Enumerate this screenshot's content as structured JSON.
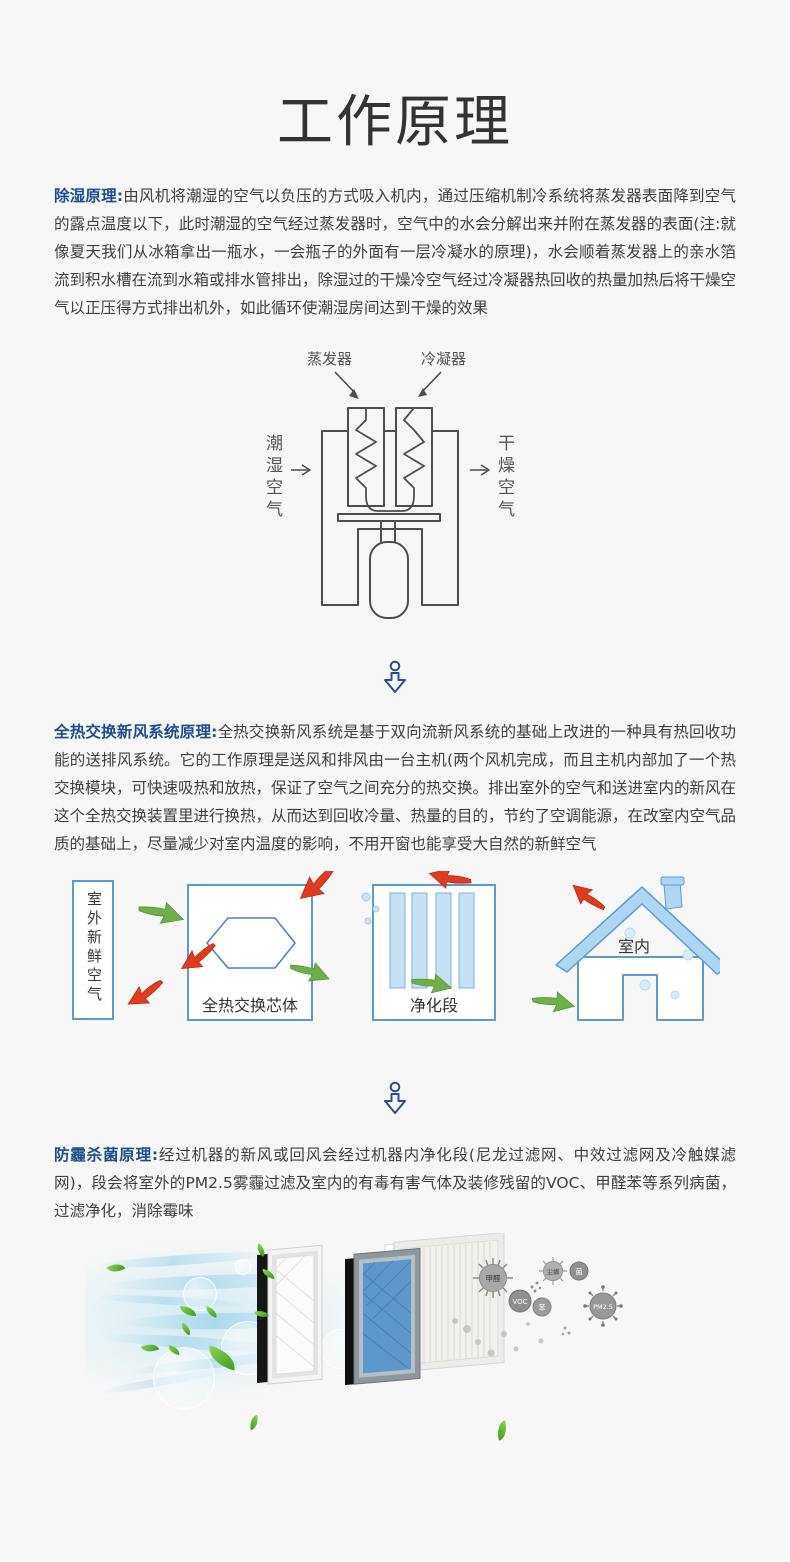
{
  "title": "工作原理",
  "sections": [
    {
      "label": "除湿原理:",
      "body": "由风机将潮湿的空气以负压的方式吸入机内，通过压缩机制冷系统将蒸发器表面降到空气的露点温度以下，此时潮湿的空气经过蒸发器时，空气中的水会分解出来并附在蒸发器的表面(注:就像夏天我们从冰箱拿出一瓶水，一会瓶子的外面有一层冷凝水的原理)，水会顺着蒸发器上的亲水箔流到积水槽在流到水箱或排水管排出，除湿过的干燥冷空气经过冷凝器热回收的热量加热后将干燥空气以正压得方式排出机外，如此循环使潮湿房间达到干燥的效果"
    },
    {
      "label": "全热交换新风系统原理:",
      "body": "全热交换新风系统是基于双向流新风系统的基础上改进的一种具有热回收功能的送排风系统。它的工作原理是送风和排风由一台主机(两个风机完成，而且主机内部加了一个热交换模块，可快速吸热和放热，保证了空气之间充分的热交换。排出室外的空气和送进室内的新风在这个全热交换装置里进行换热，从而达到回收冷量、热量的目的，节约了空调能源，在改室内空气品质的基础上，尽量减少对室内温度的影响，不用开窗也能享受大自然的新鲜空气"
    },
    {
      "label": "防霾杀菌原理:",
      "body": "经过机器的新风或回风会经过机器内净化段(尼龙过滤网、中效过滤网及冷触媒滤网)，段会将室外的PM2.5雾霾过滤及室内的有毒有害气体及装修残留的VOC、甲醛苯等系列病菌，过滤净化，消除霉味"
    }
  ],
  "diagram1": {
    "evaporator": "蒸发器",
    "condenser": "冷凝器",
    "humid_air": "潮湿空气",
    "dry_air": "干燥空气"
  },
  "diagram2": {
    "outdoor_air": "室外新鲜空气",
    "core": "全热交换芯体",
    "purify": "净化段",
    "indoor": "室内"
  },
  "filters": {
    "particles": [
      "甲醛",
      "VOC",
      "苯",
      "尘螨",
      "菌",
      "PM2.5"
    ]
  },
  "colors": {
    "accent_blue": "#1e4c8f",
    "diagram_blue": "#5b9bd5",
    "arrow_green": "#6fae4a",
    "arrow_red": "#e03a20",
    "line_gray": "#4d4d4d"
  }
}
